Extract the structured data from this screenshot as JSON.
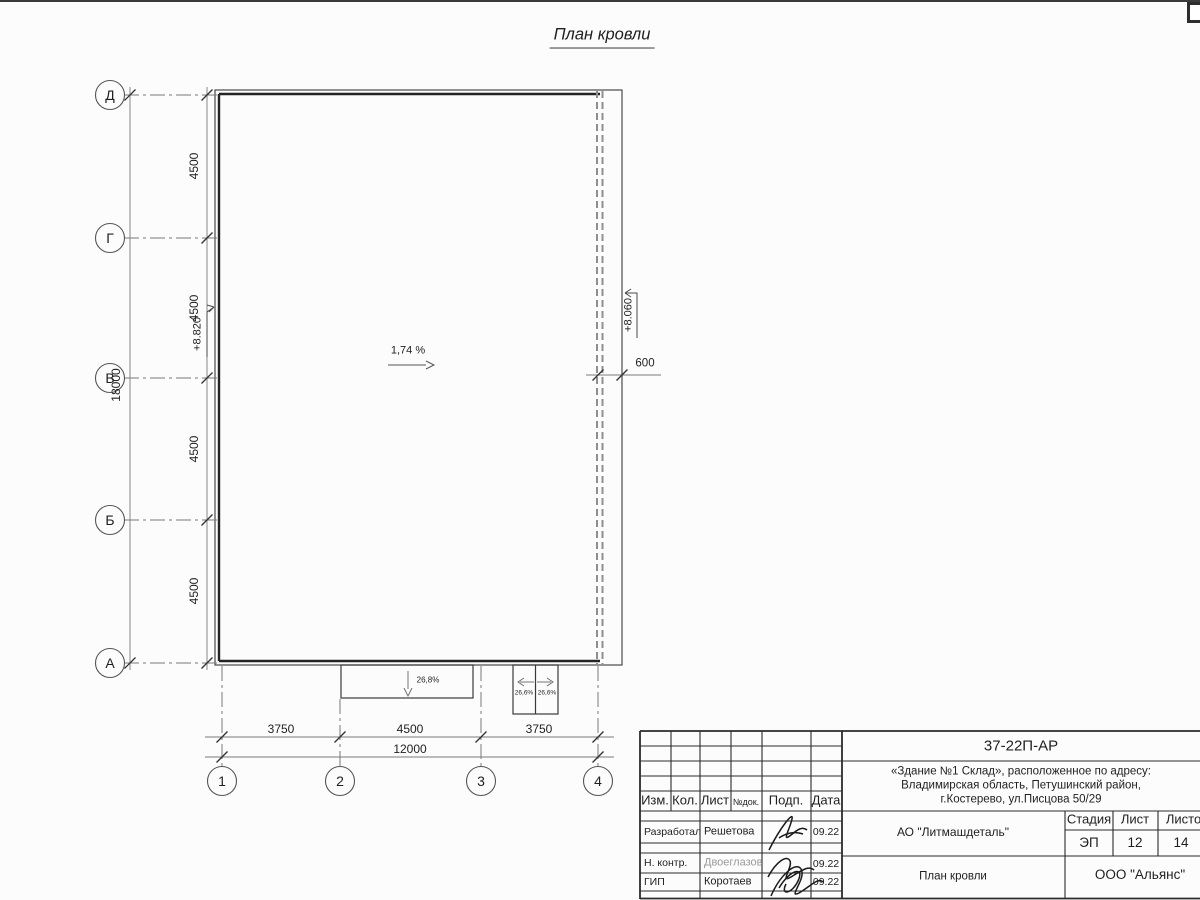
{
  "title": "План кровли",
  "drawing": {
    "slope_main": "1,74 %",
    "elevation_left": "+8.820",
    "elevation_right": "+8.060",
    "dim_overhang": "600",
    "canopy_slope_wide": "26,8%",
    "canopy_slope_left": "26,6%",
    "canopy_slope_right": "26,6%",
    "axes_rows": [
      "Д",
      "Г",
      "В",
      "Б",
      "А"
    ],
    "axes_cols": [
      "1",
      "2",
      "3",
      "4"
    ],
    "dims_left_segments": [
      "4500",
      "4500",
      "4500",
      "4500"
    ],
    "dim_left_total": "18000",
    "dims_bottom_segments": [
      "3750",
      "4500",
      "3750"
    ],
    "dim_bottom_total": "12000"
  },
  "titleblock": {
    "doc_number": "37-22П-АР",
    "project_line1": "«Здание №1 Склад», расположенное по адресу:",
    "project_line2": "Владимирская область, Петушинский район,",
    "project_line3": "г.Костерево, ул.Писцова 50/29",
    "columns": {
      "izm": "Изм.",
      "kol": "Кол.",
      "list": "Лист",
      "ndok": "№док.",
      "podp": "Подп.",
      "data": "Дата"
    },
    "rows": [
      {
        "role": "Разработал",
        "name": "Решетова",
        "date": "09.22"
      },
      {
        "role": "Н. контр.",
        "name": "Двоеглазов",
        "date": "09.22"
      },
      {
        "role": "ГИП",
        "name": "Коротаев",
        "date": "09.22"
      }
    ],
    "company": "АО \"Литмашдеталь\"",
    "stage_label": "Стадия",
    "sheet_label": "Лист",
    "sheets_label": "Листов",
    "stage": "ЭП",
    "sheet": "12",
    "sheets": "14",
    "sheet_title": "План кровли",
    "org": "ООО \"Альянс\"",
    "line_color": "#2b2b2b",
    "dim_color": "#777777"
  }
}
